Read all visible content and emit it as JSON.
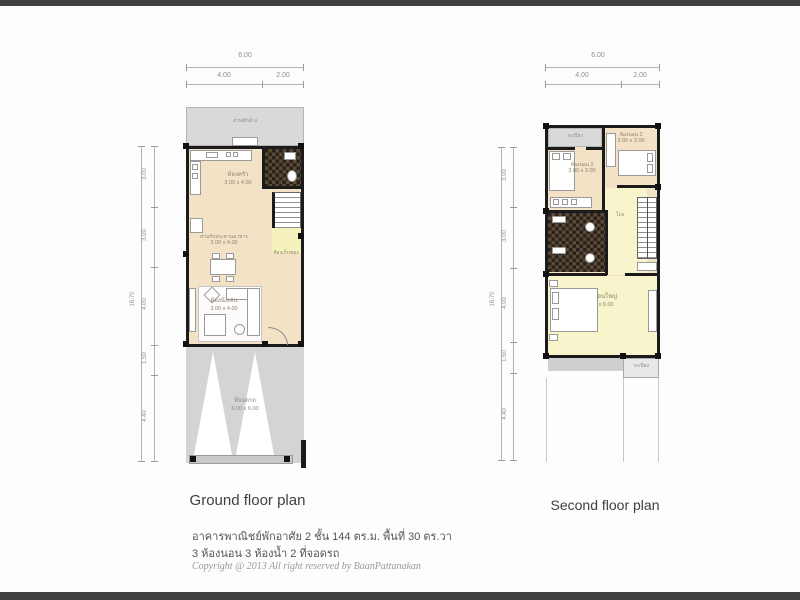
{
  "letterbox": {
    "color": "#414141"
  },
  "ground_floor": {
    "title": "Ground floor plan",
    "dims_top": {
      "total": "6.00",
      "segments": [
        "4.00",
        "2.00"
      ]
    },
    "dims_left": {
      "total": "16.70",
      "segments": [
        "3.00",
        "3.00",
        "4.00",
        "1.50",
        "4.40"
      ]
    },
    "rooms": {
      "washing_area": {
        "name": "ส่วนซักล้าง"
      },
      "kitchen": {
        "name": "ห้องครัว",
        "size": "3.00 x 4.00"
      },
      "dining": {
        "name": "ส่วนรับประทานอาหาร",
        "size": "3.00 x 4.00"
      },
      "living": {
        "name": "ห้องนั่งเล่น",
        "size": "3.00 x 4.00"
      },
      "under_stair_storage": {
        "name": "ห้องเก็บของ"
      },
      "carport": {
        "name": "ที่จอดรถ",
        "size": "6.00 x 6.00"
      }
    }
  },
  "second_floor": {
    "title": "Second floor plan",
    "dims_top": {
      "total": "6.00",
      "segments": [
        "4.00",
        "2.00"
      ]
    },
    "dims_left": {
      "total": "16.70",
      "segments": [
        "3.00",
        "3.00",
        "4.00",
        "1.50",
        "4.40"
      ]
    },
    "rooms": {
      "front_balcony": {
        "name": "ระเบียง"
      },
      "bedroom_2": {
        "name": "ห้องนอน 2",
        "size": "3.00 x 3.00"
      },
      "bedroom_3": {
        "name": "ห้องนอน 3",
        "size": "3.00 x 3.00"
      },
      "hall": {
        "name": "โถง"
      },
      "master_bedroom": {
        "name": "ห้องนอนใหญ่",
        "size": "3.60 x 6.00"
      },
      "rear_balcony": {
        "name": "ระเบียง"
      }
    }
  },
  "description": {
    "line1": "อาคารพาณิชย์พักอาศัย 2 ชั้น 144 ตร.ม. พื้นที่ 30 ตร.วา",
    "line2": "3 ห้องนอน 3 ห้องน้ำ 2 ที่จอดรถ",
    "copyright": "Copyright @ 2013 All right reserved by BaanPattanakan"
  },
  "colors": {
    "floor_cream": "#f3e2c6",
    "highlight_yellow": "#f6f2bb",
    "gray_area": "#d9d9d9",
    "carport_gray": "#d4d4d4",
    "tile_dark": "#2b2119",
    "wall": "#1b1b1b"
  }
}
